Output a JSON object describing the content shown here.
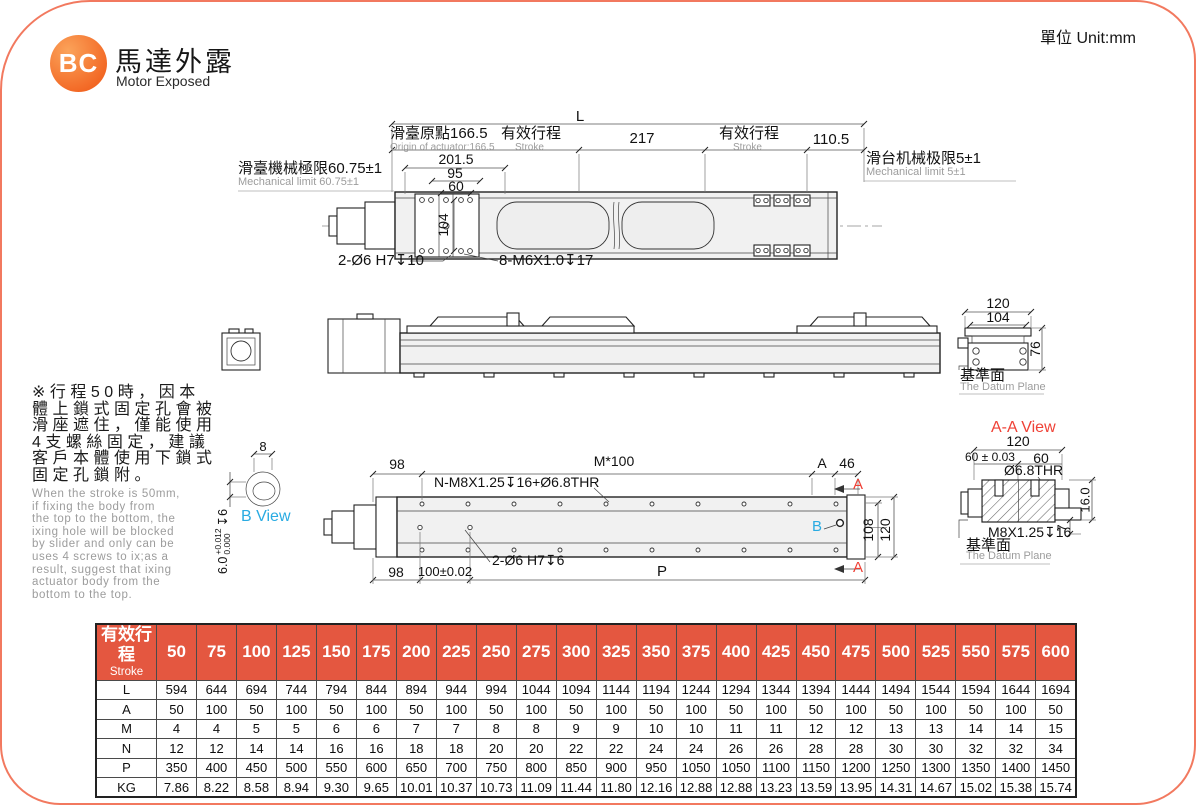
{
  "header": {
    "logo": "BC",
    "title_zh": "馬達外露",
    "title_en": "Motor Exposed",
    "unit": "單位 Unit:mm"
  },
  "colors": {
    "accent_red": "#ef4136",
    "table_header": "#e45740",
    "cyan": "#29abe2",
    "border_salmon": "#f2795f",
    "logo_orange": "#f26522"
  },
  "top_view": {
    "L": "L",
    "origin_zh": "滑臺原點166.5",
    "origin_en": "Origin of actuator:166.5",
    "stroke_zh": "有效行程",
    "stroke_en": "Stroke",
    "d217": "217",
    "d110": "110.5",
    "mech_left_zh": "滑臺機械極限60.75±1",
    "mech_left_en": "Mechanical limit 60.75±1",
    "mech_right_zh": "滑台机械极限5±1",
    "mech_right_en": "Mechanical limit 5±1",
    "d201": "201.5",
    "d95": "95",
    "d60": "60",
    "d104": "104",
    "hole_note_1": "2-Ø6 H7↧10",
    "hole_note_2": "8-M6X1.0↧17"
  },
  "end_view": {
    "d120": "120",
    "d104": "104",
    "d76": "76",
    "datum_zh": "基準面",
    "datum_en": "The Datum Plane"
  },
  "note": {
    "zh": "※行程50時，因本\n體上鎖式固定孔會被\n滑座遮住，僅能使用\n4支螺絲固定，建議\n客戶本體使用下鎖式\n固定孔鎖附。",
    "en": "When the stroke is 50mm,\nif fixing the body from\nthe top to the bottom, the\nixing hole will be blocked\nby slider and only can be\nuses 4 screws to ix;as a\nresult, suggest that ixing\nactuator body from the\nbottom to the top."
  },
  "b_view": {
    "label": "B View",
    "d8": "8",
    "tol_nominal": "6.0",
    "tol_plus": "+0.012",
    "tol_minus": "0.000",
    "tol_depth": "↧6"
  },
  "bottom_view": {
    "d98_top": "98",
    "m100": "M*100",
    "thread_note": "N-M8X1.25↧16+Ø6.8THR",
    "dA": "A",
    "d46": "46",
    "section_label": "A",
    "detail_label": "B",
    "d108": "108",
    "d120": "120",
    "d98_bot": "98",
    "d100": "100±0.02",
    "hole_note": "2-Ø6 H7↧6",
    "P": "P"
  },
  "aa_view": {
    "title": "A-A View",
    "d120": "120",
    "d60tol": "60 ± 0.03",
    "d60": "60",
    "thr": "Ø6.8THR",
    "d16": "16.0",
    "d7": "7",
    "thread": "M8X1.25↧16",
    "datum_zh": "基準面",
    "datum_en": "The Datum Plane"
  },
  "table": {
    "header_zh": "有效行程",
    "header_en": "Stroke",
    "strokes": [
      "50",
      "75",
      "100",
      "125",
      "150",
      "175",
      "200",
      "225",
      "250",
      "275",
      "300",
      "325",
      "350",
      "375",
      "400",
      "425",
      "450",
      "475",
      "500",
      "525",
      "550",
      "575",
      "600"
    ],
    "rows": [
      {
        "label": "L",
        "values": [
          "594",
          "644",
          "694",
          "744",
          "794",
          "844",
          "894",
          "944",
          "994",
          "1044",
          "1094",
          "1144",
          "1194",
          "1244",
          "1294",
          "1344",
          "1394",
          "1444",
          "1494",
          "1544",
          "1594",
          "1644",
          "1694"
        ]
      },
      {
        "label": "A",
        "values": [
          "50",
          "100",
          "50",
          "100",
          "50",
          "100",
          "50",
          "100",
          "50",
          "100",
          "50",
          "100",
          "50",
          "100",
          "50",
          "100",
          "50",
          "100",
          "50",
          "100",
          "50",
          "100",
          "50"
        ]
      },
      {
        "label": "M",
        "values": [
          "4",
          "4",
          "5",
          "5",
          "6",
          "6",
          "7",
          "7",
          "8",
          "8",
          "9",
          "9",
          "10",
          "10",
          "11",
          "11",
          "12",
          "12",
          "13",
          "13",
          "14",
          "14",
          "15"
        ]
      },
      {
        "label": "N",
        "values": [
          "12",
          "12",
          "14",
          "14",
          "16",
          "16",
          "18",
          "18",
          "20",
          "20",
          "22",
          "22",
          "24",
          "24",
          "26",
          "26",
          "28",
          "28",
          "30",
          "30",
          "32",
          "32",
          "34"
        ]
      },
      {
        "label": "P",
        "values": [
          "350",
          "400",
          "450",
          "500",
          "550",
          "600",
          "650",
          "700",
          "750",
          "800",
          "850",
          "900",
          "950",
          "1050",
          "1050",
          "1100",
          "1150",
          "1200",
          "1250",
          "1300",
          "1350",
          "1400",
          "1450"
        ]
      },
      {
        "label": "KG",
        "values": [
          "7.86",
          "8.22",
          "8.58",
          "8.94",
          "9.30",
          "9.65",
          "10.01",
          "10.37",
          "10.73",
          "11.09",
          "11.44",
          "11.80",
          "12.16",
          "12.88",
          "12.88",
          "13.23",
          "13.59",
          "13.95",
          "14.31",
          "14.67",
          "15.02",
          "15.38",
          "15.74"
        ]
      }
    ]
  }
}
